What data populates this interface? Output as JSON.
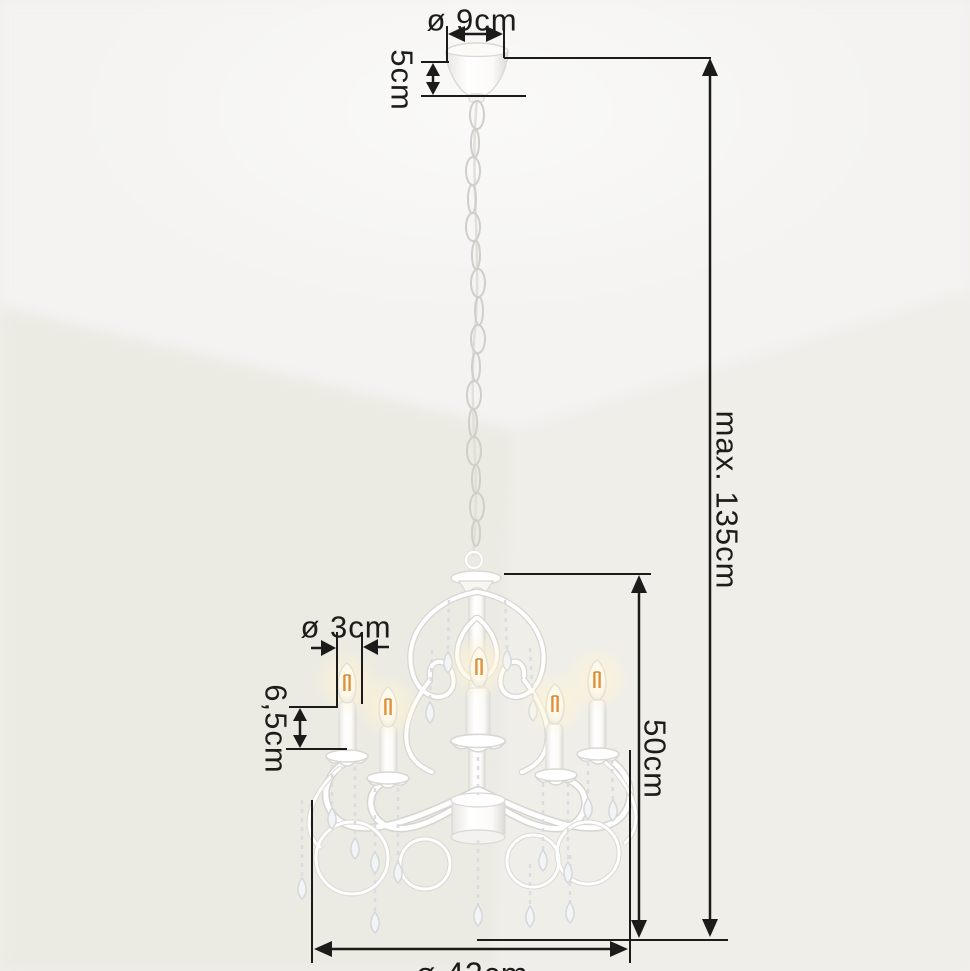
{
  "image": {
    "kind": "product dimension photo",
    "subject": "white 5-arm crystal chandelier hanging from ceiling canopy in room corner"
  },
  "labels": {
    "canopy_diameter": "ø 9cm",
    "canopy_height": "5cm",
    "max_hanging_height": "max. 135cm",
    "fixture_height": "50cm",
    "candle_diameter": "ø 3cm",
    "candle_height": "6,5cm",
    "fixture_diameter": "ø 42cm"
  },
  "colors": {
    "annotation_line": "#1b1b19",
    "background": "#f0efec",
    "ceiling": "#f4f3f1",
    "wall_left": "#ebeae3",
    "wall_right": "#efeee9",
    "chandelier_white": "#ffffff",
    "chandelier_shade": "#d8d7d2",
    "bulb_glow": "#ffeec2",
    "filament": "#e0913c",
    "crystal": "#eef1f4"
  }
}
